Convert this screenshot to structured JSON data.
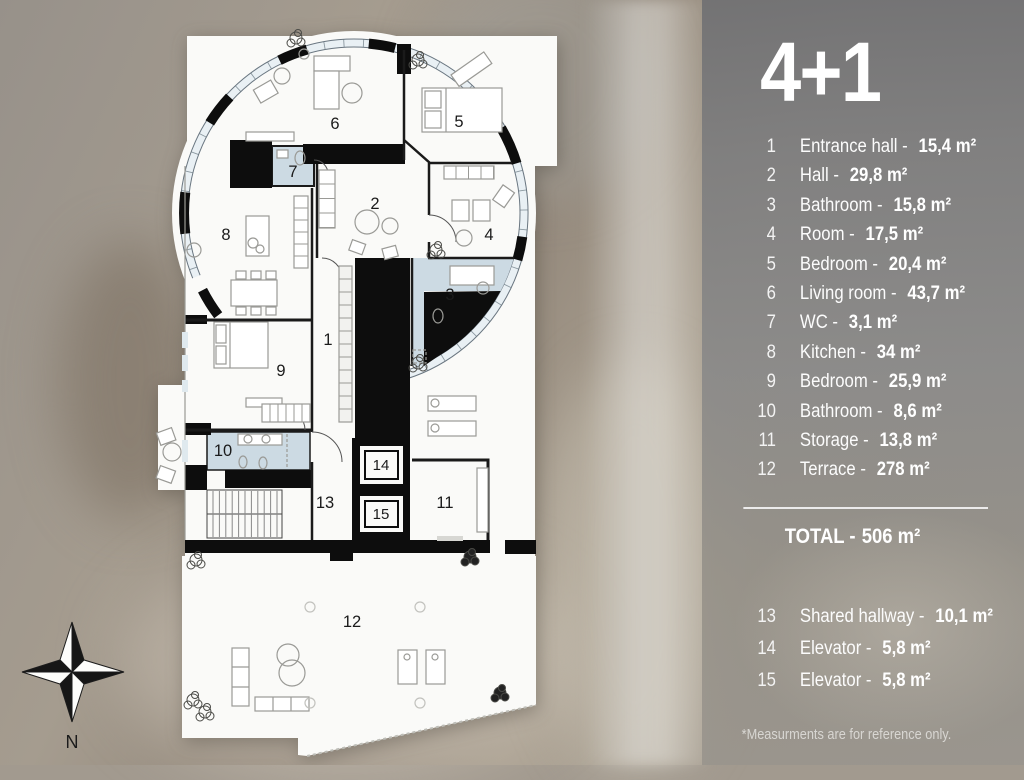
{
  "legend": {
    "title": "4+1",
    "total_label": "TOTAL -",
    "total_area": "506 m²",
    "footnote": "*Measurments are for reference only.",
    "rooms_main": [
      {
        "num": "1",
        "name": "Entrance hall -",
        "area": "15,4 m²"
      },
      {
        "num": "2",
        "name": "Hall -",
        "area": "29,8 m²"
      },
      {
        "num": "3",
        "name": "Bathroom -",
        "area": "15,8 m²"
      },
      {
        "num": "4",
        "name": "Room -",
        "area": "17,5 m²"
      },
      {
        "num": "5",
        "name": "Bedroom -",
        "area": "20,4 m²"
      },
      {
        "num": "6",
        "name": "Living room -",
        "area": "43,7 m²"
      },
      {
        "num": "7",
        "name": "WC -",
        "area": "3,1 m²"
      },
      {
        "num": "8",
        "name": "Kitchen -",
        "area": "34 m²"
      },
      {
        "num": "9",
        "name": "Bedroom -",
        "area": "25,9 m²"
      },
      {
        "num": "10",
        "name": "Bathroom -",
        "area": "8,6 m²"
      },
      {
        "num": "11",
        "name": "Storage -",
        "area": "13,8 m²"
      },
      {
        "num": "12",
        "name": "Terrace -",
        "area": "278 m²"
      }
    ],
    "rooms_annex": [
      {
        "num": "13",
        "name": "Shared hallway -",
        "area": "10,1 m²"
      },
      {
        "num": "14",
        "name": "Elevator -",
        "area": "5,8 m²"
      },
      {
        "num": "15",
        "name": "Elevator -",
        "area": "5,8 m²"
      }
    ]
  },
  "plan": {
    "north_label": "N"
  },
  "colors": {
    "wall": "#0d0d0d",
    "bath_floor": "#ccdae3",
    "paper": "#fafaf8",
    "panel": "#888888"
  }
}
